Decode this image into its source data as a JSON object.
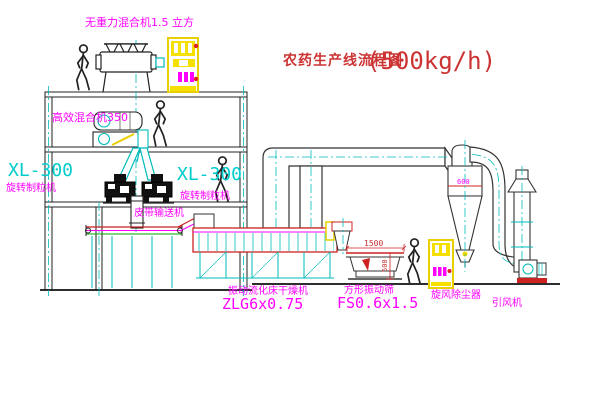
{
  "title": {
    "text": "农药生产线流程图",
    "capacity": "(500kg/h)"
  },
  "labels": {
    "mixer_top": "无重力混合机1.5 立方",
    "mixer_high": "高效混合机350",
    "granulator_left_model": "XL-300",
    "granulator_left_name": "旋转制粒机",
    "granulator_right_model": "XL-300",
    "granulator_right_name": "旋转制粒机",
    "conveyor": "皮带输送机",
    "dryer_name": "振动流化床干燥机",
    "dryer_model": "ZLG6x0.75",
    "sieve_name": "方形振动筛",
    "sieve_model": "FS0.6x1.5",
    "cyclone": "旋风除尘器",
    "fan": "引风机"
  },
  "dimensions": {
    "sieve_length": "1500",
    "sieve_height": "500",
    "cyclone_diameter": "600"
  },
  "colors": {
    "label_magenta": "#ff00ff",
    "label_cyan": "#00cccc",
    "title_red": "#cc3333",
    "equipment_yellow": "#f0d800",
    "line_dark": "#222222",
    "centerline_cyan": "#00bbbb",
    "belt_green": "#00aa00",
    "background": "#ffffff"
  }
}
